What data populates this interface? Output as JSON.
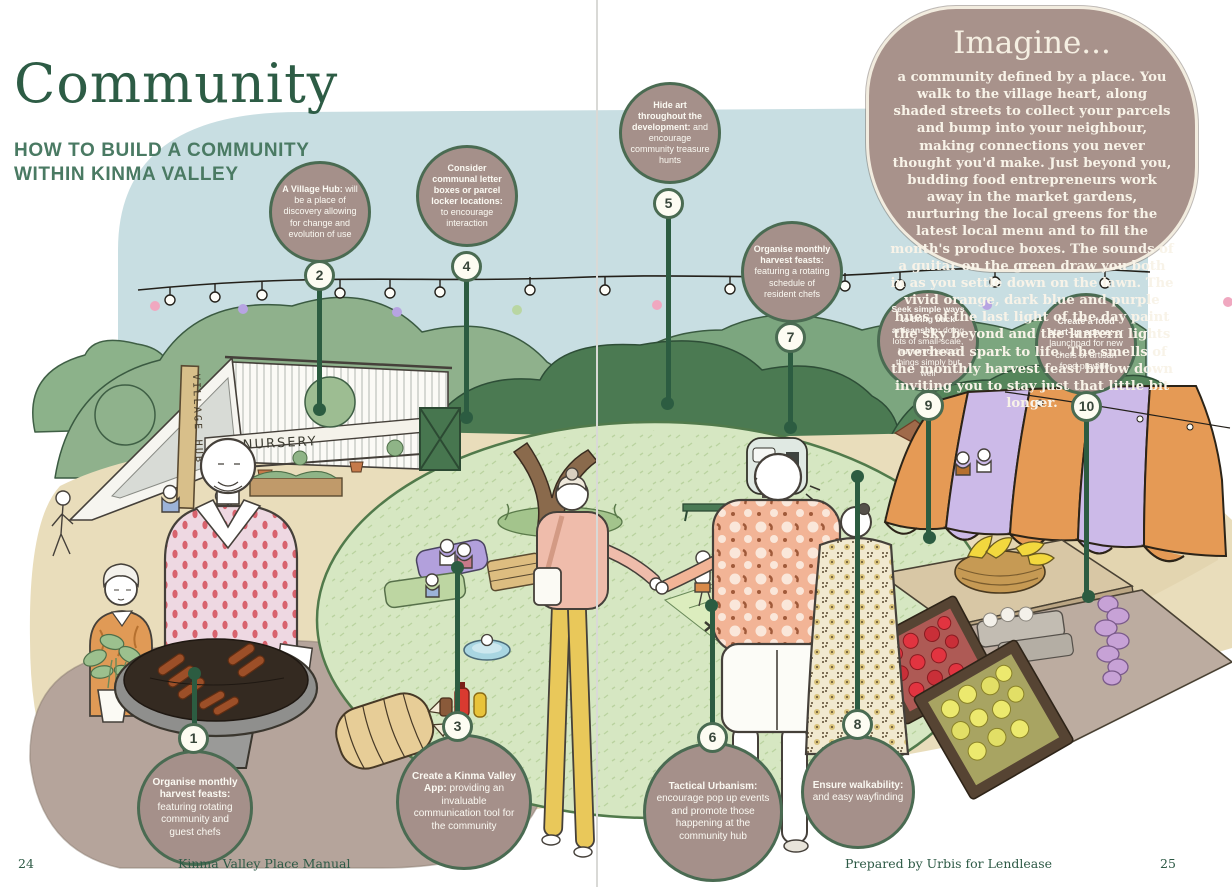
{
  "header": {
    "title": "Community",
    "subtitle_line1": "HOW TO BUILD A COMMUNITY",
    "subtitle_line2": "WITHIN KINMA VALLEY"
  },
  "imagine": {
    "heading": "Imagine...",
    "body": "a community defined by a place. You walk to the village heart, along shaded streets to collect your parcels and bump into your neighbour, making connections you never thought you'd make. Just beyond you, budding food entrepreneurs work away in the market gardens, nurturing the local greens for the latest local menu and to fill the month's produce boxes. The sounds of a guitar on the green draw you both in as you settle down on the lawn. The vivid orange, dark blue and purple hues of the last light of the day paint the sky beyond and the lantern lights overhead spark to life. The smells of the monthly harvest feast billow down inviting you to stay just that little bit longer."
  },
  "callouts": [
    {
      "num": "1",
      "strong": "Organise monthly harvest feasts:",
      "rest": " featuring rotating community and guest chefs"
    },
    {
      "num": "2",
      "strong": "A Village Hub:",
      "rest": " will be a place of discovery allowing for change and evolution of use"
    },
    {
      "num": "3",
      "strong": "Create a Kinma Valley App:",
      "rest": " providing an invaluable communication tool for the community"
    },
    {
      "num": "4",
      "strong": "Consider communal letter boxes or parcel locker locations:",
      "rest": " to encourage interaction"
    },
    {
      "num": "5",
      "strong": "Hide art throughout the development:",
      "rest": " and encourage community treasure hunts"
    },
    {
      "num": "6",
      "strong": "Tactical Urbanism:",
      "rest": " encourage pop up events and promote those happening at the community hub"
    },
    {
      "num": "7",
      "strong": "Organise monthly harvest feasts:",
      "rest": " featuring a rotating schedule of resident chefs"
    },
    {
      "num": "8",
      "strong": "Ensure walkability:",
      "rest": " and easy wayfinding"
    },
    {
      "num": "9",
      "strong": "Seek simple ways to bring back artisanship:",
      "rest": " doing lots of small-scale, human oriented things simply but well"
    },
    {
      "num": "10",
      "strong": "Create a food start-up space:",
      "rest": " or launchpad for new chefs or artisan food provider"
    }
  ],
  "illustration": {
    "village_hub_sign": "VILLAGE HUB",
    "nursery_sign": "NURSERY"
  },
  "footer": {
    "page_number_left": "24",
    "manual_title": "Kinma Valley Place Manual",
    "prepared_by": "Prepared by Urbis  for Lendlease",
    "page_number_right": "25"
  },
  "colors": {
    "heading_green": "#2d5c45",
    "subtitle_green": "#4a7a63",
    "bubble_fill": "#a5908a",
    "bubble_border": "#4a6b52",
    "leader_green": "#2c5c41",
    "imagine_fill": "#a8928b",
    "imagine_border": "#f2ecdf",
    "sky_blue": "#c8dee2",
    "lawn_green": "#d6e7c2",
    "ground_beige": "#e9ddbb",
    "ground_taupe": "#b5a49b",
    "awning_orange": "#e59a55",
    "awning_purple": "#ccbae8"
  }
}
